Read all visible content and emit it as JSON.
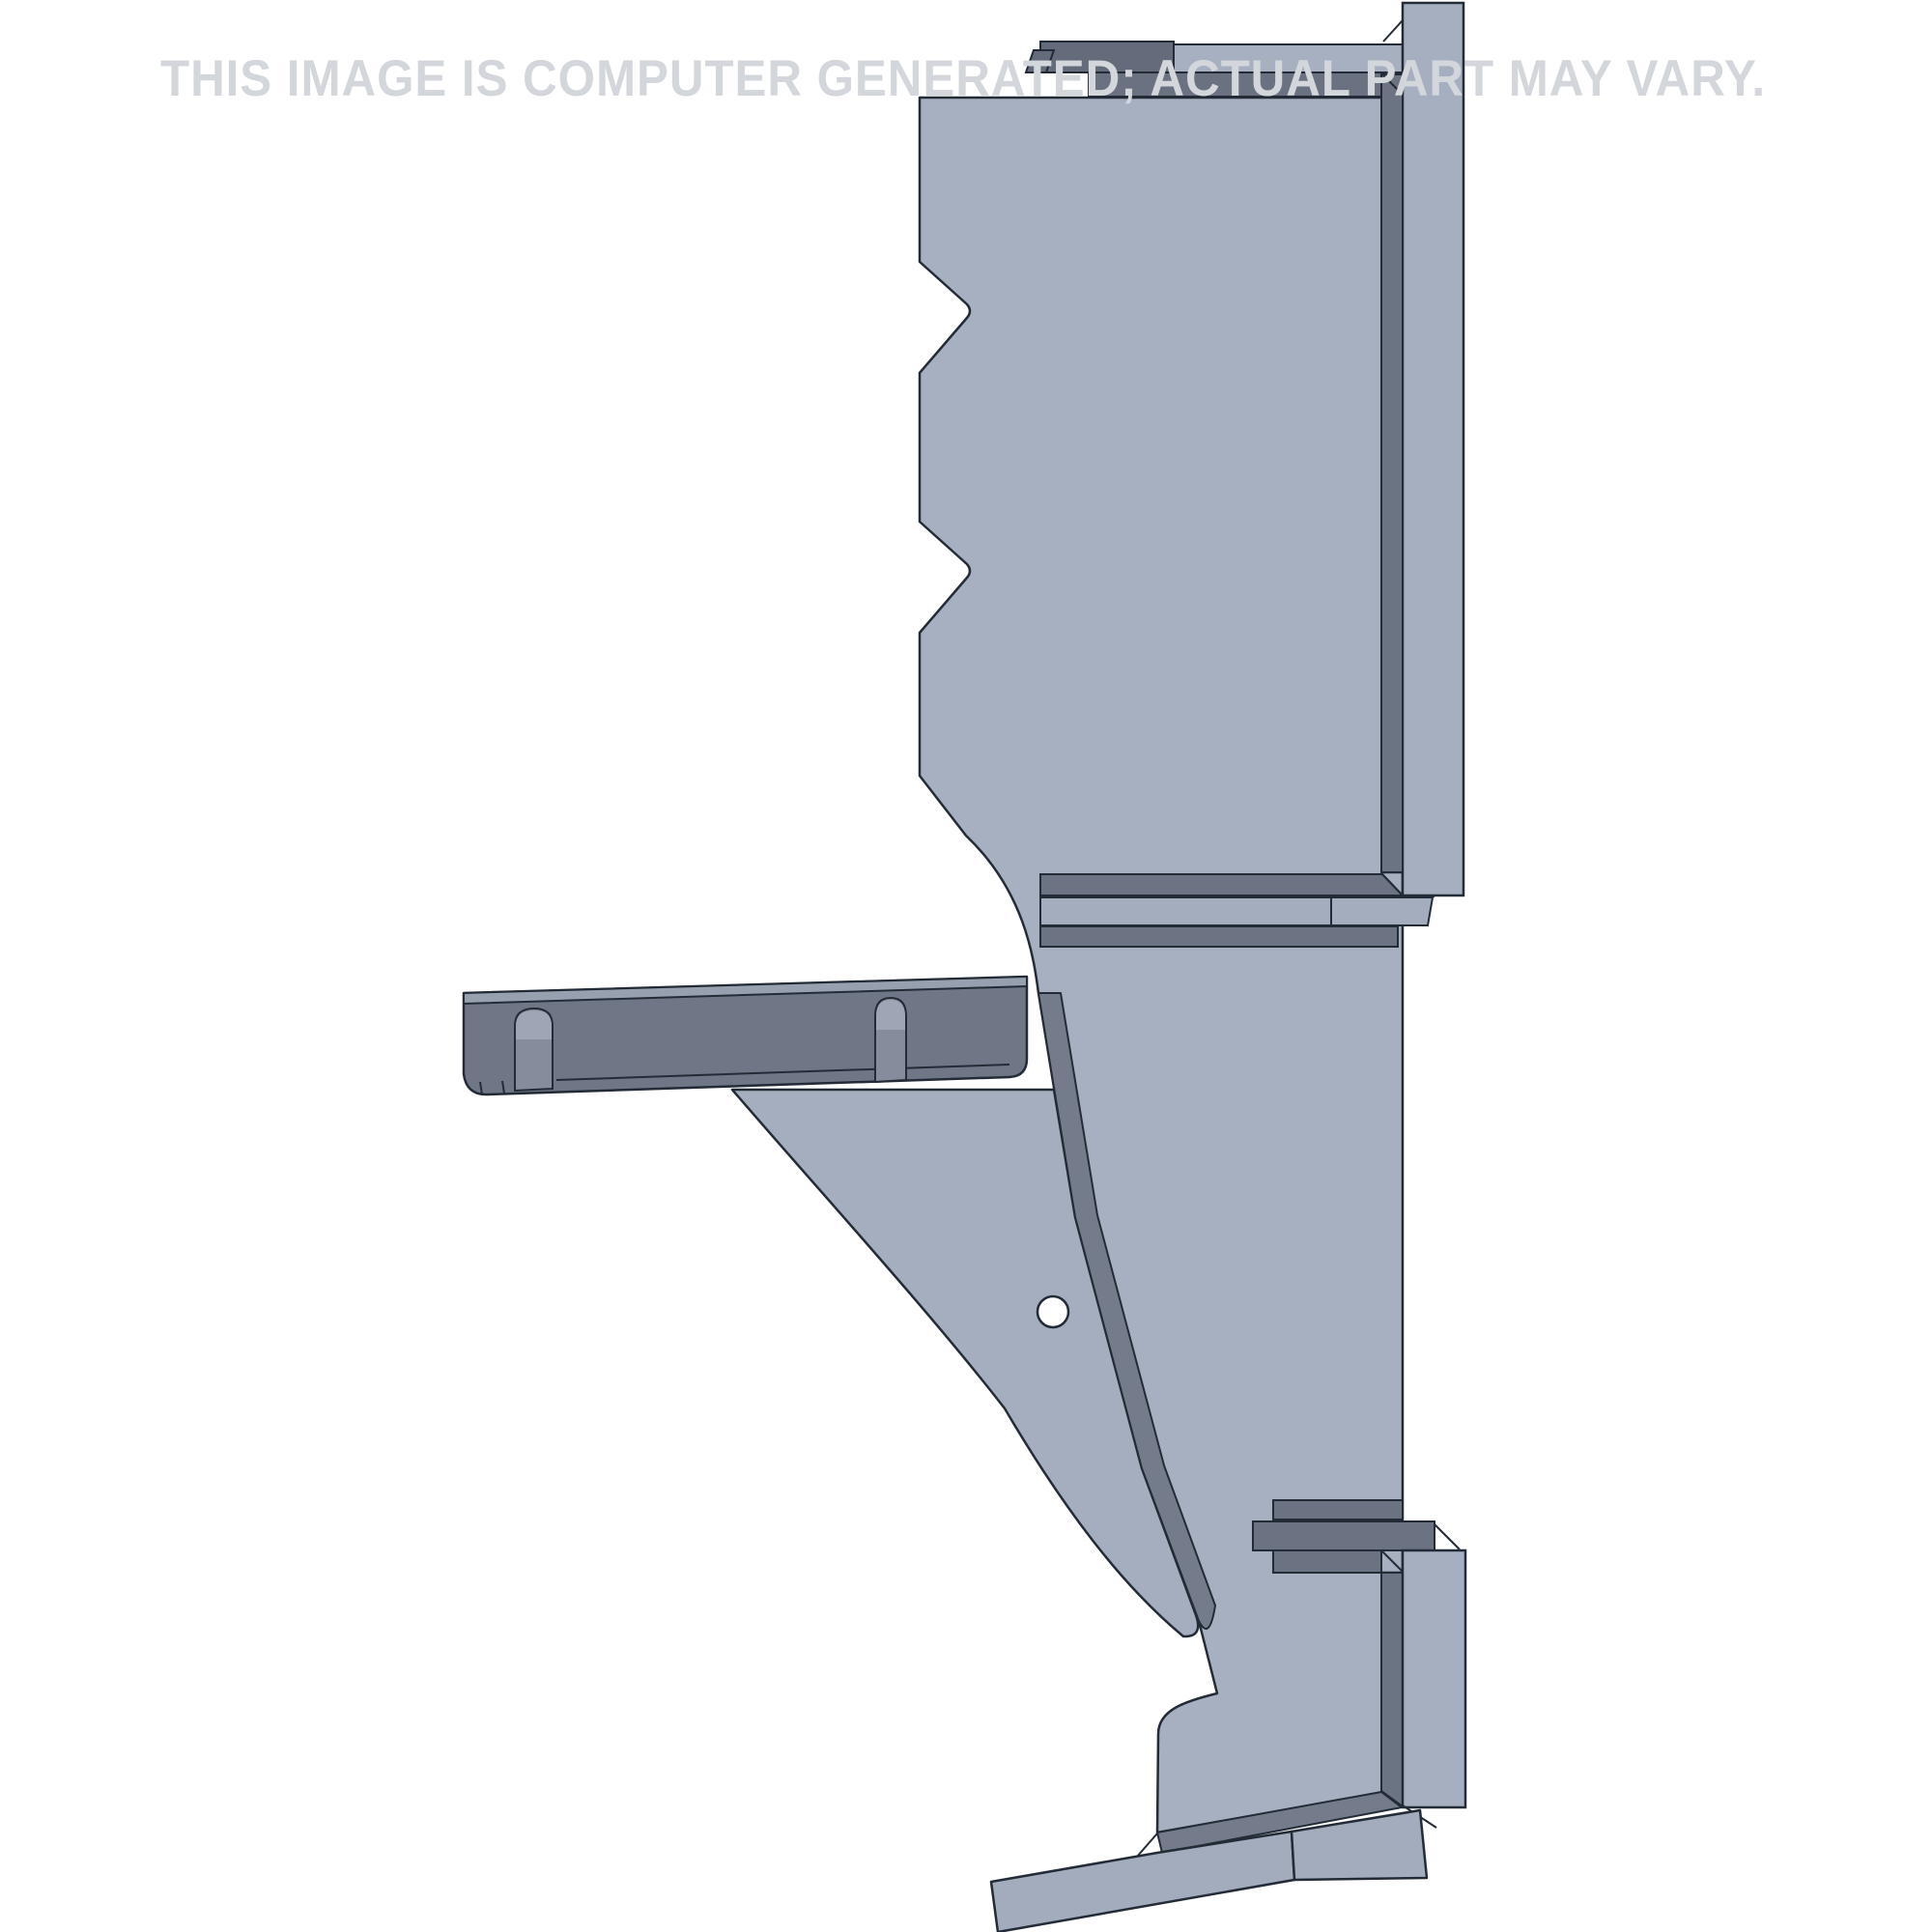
{
  "watermark": {
    "text": "THIS IMAGE IS COMPUTER GENERATED; ACTUAL PART MAY VARY."
  },
  "part": {
    "description": "CAD render of a steel shelf-bracket part, side view",
    "hole_label": "mounting-hole",
    "shelf_label": "slotted shelf arm",
    "gusset_label": "triangular gusset",
    "rail_label": "mounting rail"
  },
  "colors": {
    "background": "#ffffff",
    "outline": "#232b36",
    "face_light": "#a7b0c1",
    "face_light2": "#a3adbe",
    "rail": "#a6afc0",
    "foot": "#a3acbd",
    "gusset": "#a5aebf",
    "flange_dark": "#646c7b",
    "under_bar": "#6a7281",
    "strip_dark": "#6c7483",
    "band": "#747c8b",
    "lower_bars": "#6b7383",
    "shelf_face": "#6f7787",
    "shelf_top": "#97a0af",
    "slot_body": "#858d9c",
    "slot_head": "#9ea6b5",
    "hole": "#ffffff",
    "watermark": "#d3d6db"
  }
}
